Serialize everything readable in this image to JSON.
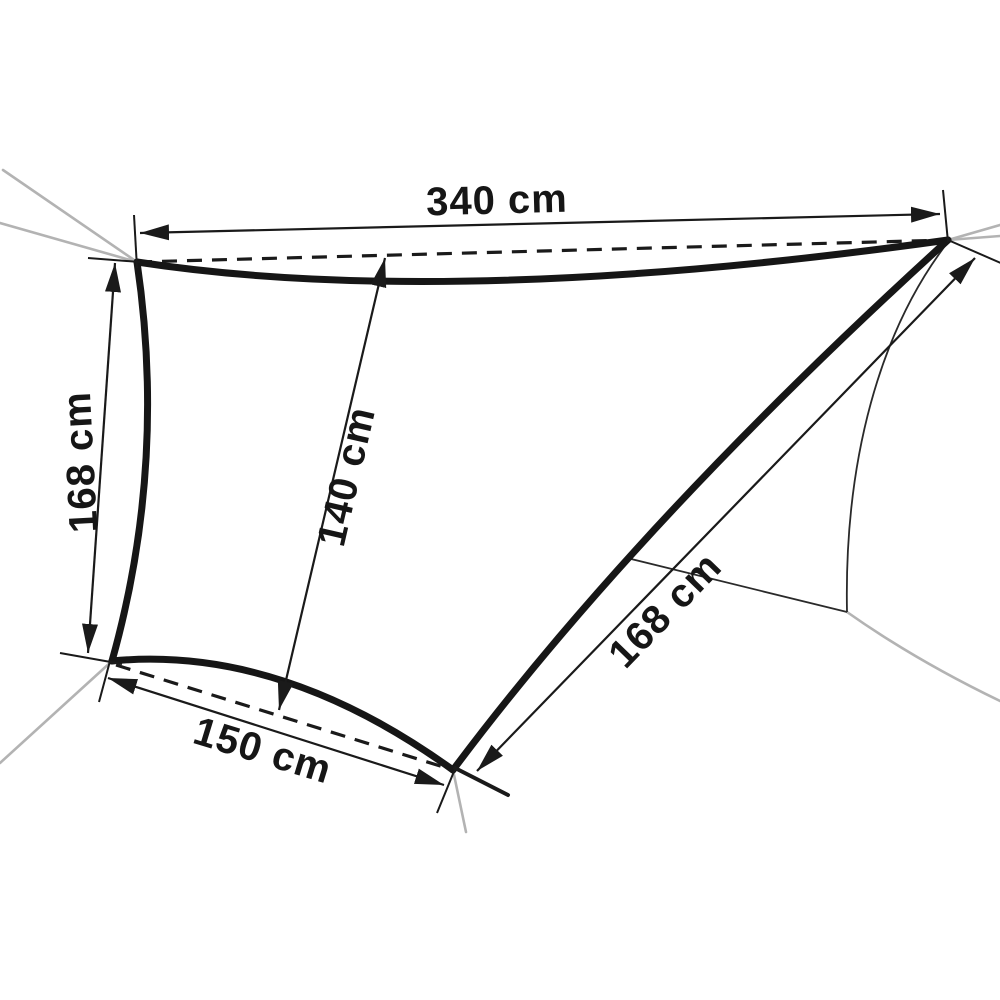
{
  "diagram": {
    "background_color": "#ffffff",
    "ink_color": "#161616",
    "guy_line_color": "#b3b3b3",
    "labels": {
      "top_edge": "340 cm",
      "left_edge": "168 cm",
      "center_height": "140 cm",
      "bottom_edge": "150 cm",
      "right_edge": "168 cm"
    },
    "measurements_cm": {
      "top_edge": 340,
      "left_edge": 168,
      "center_height": 140,
      "bottom_edge": 150,
      "right_edge": 168
    }
  }
}
